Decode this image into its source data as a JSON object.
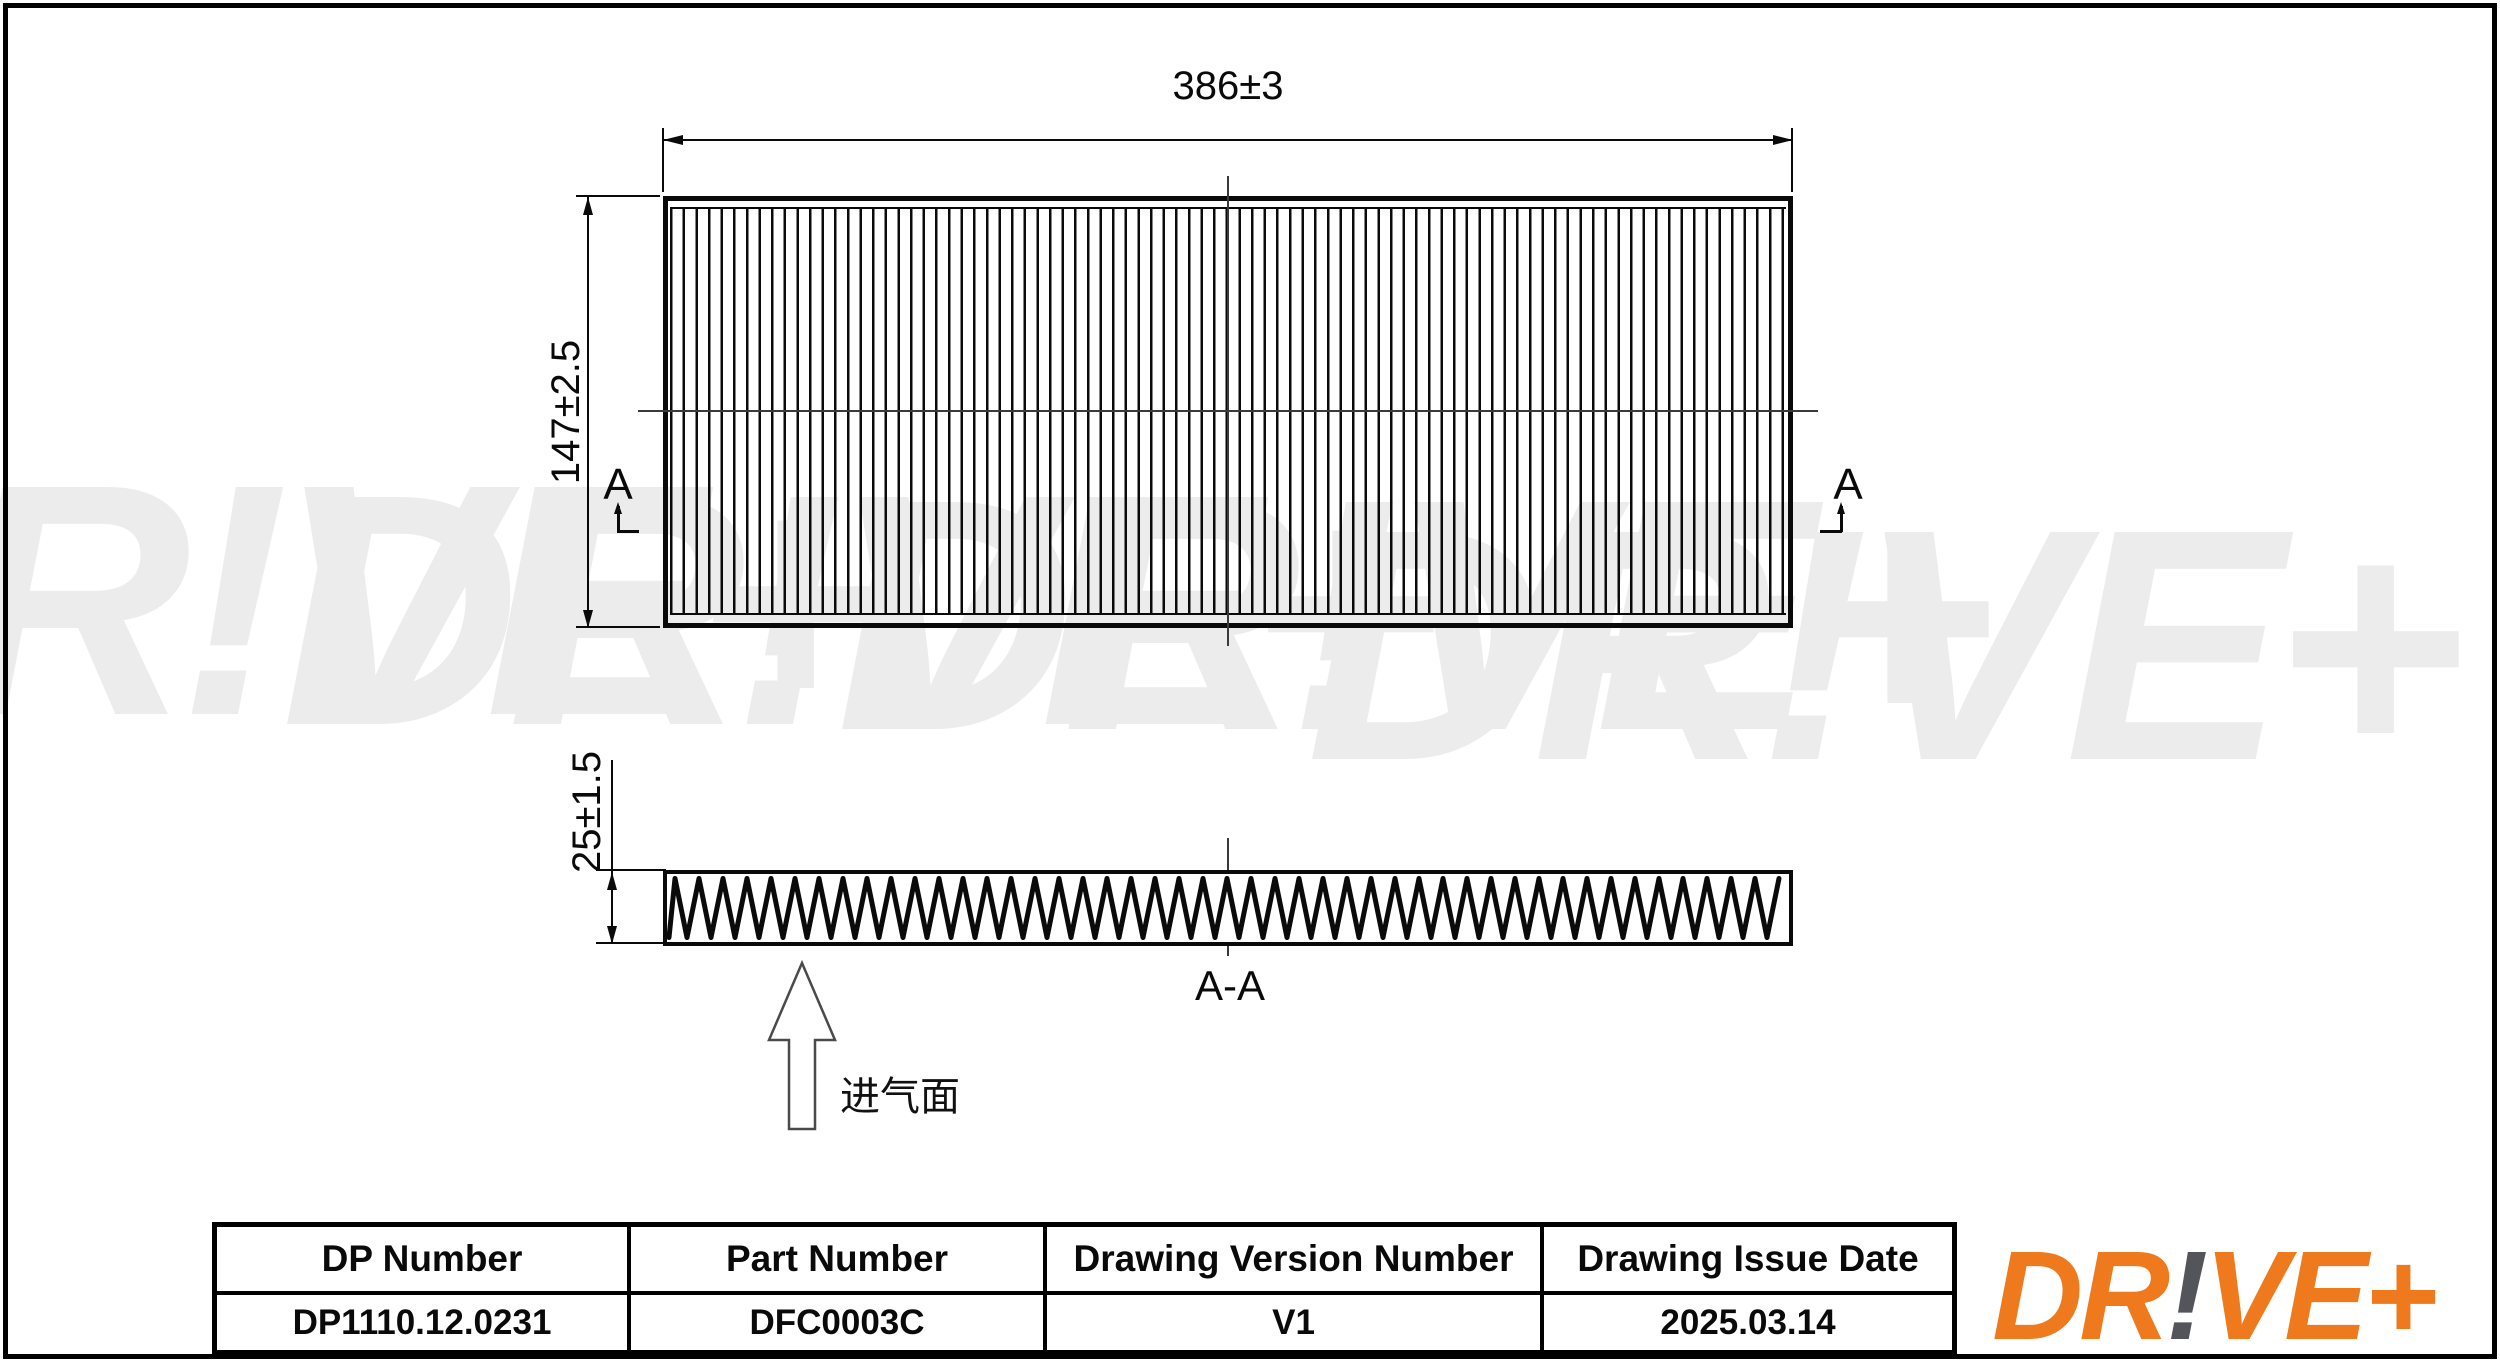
{
  "colors": {
    "line": "#0a0a0a",
    "centerline": "#3a3a3a",
    "watermark": "#ececec",
    "logo_orange": "#EF7A1D",
    "logo_gray": "#54555A"
  },
  "watermark": {
    "text": "DR!VE+"
  },
  "top_view": {
    "width_label": "386±3",
    "height_label": "147±2.5",
    "section_letter": "A"
  },
  "section_view": {
    "title": "A-A",
    "thickness_label": "25±1.5",
    "intake_label": "进气面"
  },
  "title_block": {
    "columns": [
      {
        "header": "DP Number",
        "value": "DP1110.12.0231"
      },
      {
        "header": "Part Number",
        "value": "DFC0003C"
      },
      {
        "header": "Drawing Version Number",
        "value": "V1"
      },
      {
        "header": "Drawing Issue Date",
        "value": "2025.03.14"
      }
    ]
  },
  "logo": {
    "part1": "DR",
    "bang": "!",
    "part2": "VE+"
  }
}
